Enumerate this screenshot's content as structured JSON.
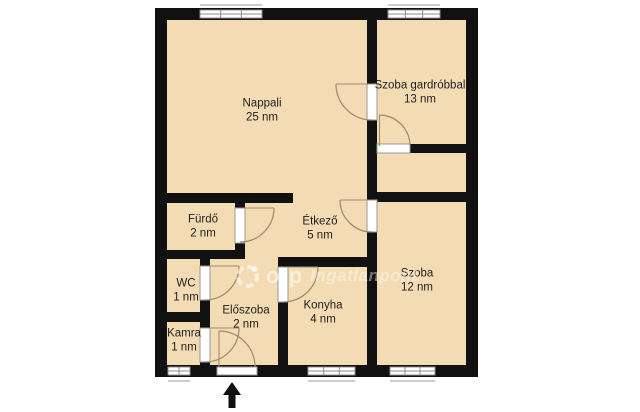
{
  "plan": {
    "title": "apartment floor plan",
    "area_unit": "nm",
    "rooms": [
      {
        "id": "nappali",
        "name": "Nappali",
        "area": "25 nm"
      },
      {
        "id": "szoba-gardrobbal",
        "name": "Szoba gardróbbal",
        "area": "13 nm"
      },
      {
        "id": "furdo",
        "name": "Fürdő",
        "area": "2 nm"
      },
      {
        "id": "etkezo",
        "name": "Étkező",
        "area": "5 nm"
      },
      {
        "id": "wc",
        "name": "WC",
        "area": "1 nm"
      },
      {
        "id": "szoba",
        "name": "Szoba",
        "area": "12 nm"
      },
      {
        "id": "eloszoba",
        "name": "Előszoba",
        "area": "2 nm"
      },
      {
        "id": "konyha",
        "name": "Konyha",
        "area": "4 nm"
      },
      {
        "id": "kamra",
        "name": "Kamra",
        "area": "1 nm"
      }
    ],
    "watermark": {
      "brand_short": "otp",
      "brand": "Ingatlanpont",
      "logo": "otp-ingatlanpont-ring-logo"
    },
    "icons": [
      {
        "name": "entrance-arrow",
        "meaning": "main entrance, points up into Előszoba"
      },
      {
        "name": "door-swing-arc",
        "meaning": "door opening direction"
      },
      {
        "name": "window-symbol",
        "meaning": "window in exterior wall"
      }
    ],
    "colors": {
      "background": "#ffffff",
      "room_fill": "#f3dbb3",
      "wall": "#111111",
      "door_frame": "#9a9a9a",
      "swing_arc": "#a18d74",
      "label_text": "#1f1f1f",
      "watermark": "#ffffff"
    }
  }
}
